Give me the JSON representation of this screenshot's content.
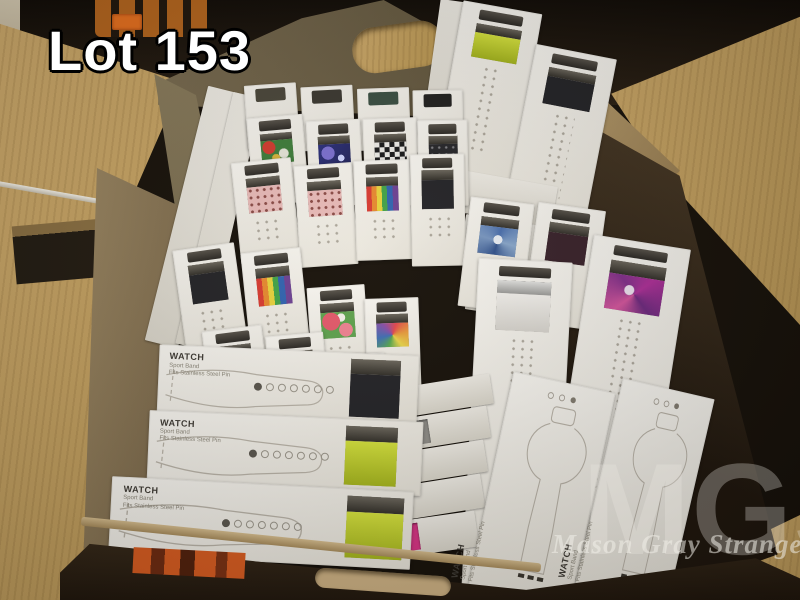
{
  "overlay": {
    "lot_label": "Lot 153"
  },
  "watermark": {
    "initials": "MGS",
    "name": "Mason Gray Strange"
  },
  "package_label": {
    "title": "WATCH",
    "line1": "Sport Band",
    "line2": "Fits Stainless Steel Pin"
  },
  "colors": {
    "cardboard_interior": "#6b5f49",
    "cardboard_exterior": "#b2976b",
    "wood_table": "#c9a869",
    "package_white": "#f4f2ec",
    "lot_sticker_orange": "#d85c20",
    "band_lime": "#c6d92e",
    "band_pink": "#d63384"
  },
  "scene": {
    "packages": [
      {
        "k": "edge",
        "x": 176,
        "y": 86,
        "w": 34,
        "h": 262,
        "r": 14
      },
      {
        "k": "edge",
        "x": 204,
        "y": 92,
        "w": 30,
        "h": 258,
        "r": 13
      },
      {
        "k": "edge",
        "x": 430,
        "y": 0,
        "w": 26,
        "h": 152,
        "r": 8
      },
      {
        "k": "tallwin",
        "x": 448,
        "y": 6,
        "w": 80,
        "h": 172,
        "r": 10,
        "b": "lime",
        "wh": 20
      },
      {
        "k": "tallwin",
        "x": 518,
        "y": 50,
        "w": 82,
        "h": 185,
        "r": 11,
        "b": "black",
        "wh": 20
      },
      {
        "k": "edge",
        "x": 455,
        "y": 178,
        "w": 100,
        "h": 42,
        "r": 10
      },
      {
        "k": "edge",
        "x": 462,
        "y": 222,
        "w": 106,
        "h": 46,
        "r": 9
      },
      {
        "k": "edge",
        "x": 468,
        "y": 268,
        "w": 112,
        "h": 50,
        "r": 9
      },
      {
        "k": "tabonly",
        "x": 246,
        "y": 84,
        "w": 52,
        "h": 64,
        "r": -4,
        "t": "#4a463a"
      },
      {
        "k": "tabonly",
        "x": 302,
        "y": 86,
        "w": 52,
        "h": 64,
        "r": -3,
        "t": "#3b3831"
      },
      {
        "k": "tabonly",
        "x": 358,
        "y": 88,
        "w": 52,
        "h": 62,
        "r": -2,
        "t": "#3a4f43"
      },
      {
        "k": "tabonly",
        "x": 413,
        "y": 90,
        "w": 50,
        "h": 62,
        "r": -1,
        "t": "#20201f"
      },
      {
        "k": "upright",
        "x": 250,
        "y": 116,
        "w": 56,
        "h": 88,
        "r": -5,
        "b": "fruit-camo"
      },
      {
        "k": "upright",
        "x": 308,
        "y": 120,
        "w": 54,
        "h": 86,
        "r": -3,
        "b": "galaxy"
      },
      {
        "k": "upright",
        "x": 364,
        "y": 118,
        "w": 54,
        "h": 88,
        "r": -2,
        "b": "checker"
      },
      {
        "k": "upright",
        "x": 418,
        "y": 120,
        "w": 50,
        "h": 86,
        "r": -1,
        "b": "black-dots"
      },
      {
        "k": "upright",
        "x": 236,
        "y": 160,
        "w": 60,
        "h": 102,
        "r": -6,
        "b": "pink-dots"
      },
      {
        "k": "upright",
        "x": 297,
        "y": 164,
        "w": 58,
        "h": 102,
        "r": -4,
        "b": "pink-dots"
      },
      {
        "k": "upright",
        "x": 355,
        "y": 160,
        "w": 56,
        "h": 100,
        "r": -2,
        "b": "rainbow"
      },
      {
        "k": "upright",
        "x": 411,
        "y": 154,
        "w": 54,
        "h": 112,
        "r": -1,
        "b": "black"
      },
      {
        "k": "upright",
        "x": 180,
        "y": 246,
        "w": 62,
        "h": 114,
        "r": -8,
        "b": "black"
      },
      {
        "k": "upright",
        "x": 246,
        "y": 250,
        "w": 60,
        "h": 112,
        "r": -6,
        "b": "rainbow"
      },
      {
        "k": "upright",
        "x": 310,
        "y": 286,
        "w": 58,
        "h": 102,
        "r": -4,
        "b": "watermelon"
      },
      {
        "k": "upright",
        "x": 366,
        "y": 298,
        "w": 54,
        "h": 96,
        "r": -2,
        "b": "tie-dye-rainbow"
      },
      {
        "k": "upright",
        "x": 206,
        "y": 328,
        "w": 60,
        "h": 74,
        "r": -7,
        "b": "black"
      },
      {
        "k": "upright",
        "x": 268,
        "y": 334,
        "w": 58,
        "h": 68,
        "r": -5,
        "b": "pink-dots"
      },
      {
        "k": "upright",
        "x": 330,
        "y": 354,
        "w": 56,
        "h": 62,
        "r": -3,
        "b": "watermelon"
      },
      {
        "k": "tallwin",
        "x": 464,
        "y": 200,
        "w": 64,
        "h": 110,
        "r": 7,
        "b": "tie-dye-blue",
        "wh": 34
      },
      {
        "k": "tallwin",
        "x": 530,
        "y": 206,
        "w": 68,
        "h": 120,
        "r": 8,
        "b": "maroon",
        "wh": 32
      },
      {
        "k": "tallwin",
        "x": 470,
        "y": 260,
        "w": 94,
        "h": 332,
        "r": 3,
        "b": "white",
        "wh": 15,
        "lug": "silver"
      },
      {
        "k": "tallwin",
        "x": 566,
        "y": 240,
        "w": 98,
        "h": 352,
        "r": 9,
        "b": "tie-dye-pink",
        "wh": 14
      },
      {
        "k": "edge",
        "x": 408,
        "y": 380,
        "w": 84,
        "h": 30,
        "r": -9
      },
      {
        "k": "edgewin",
        "x": 405,
        "y": 412,
        "w": 84,
        "h": 32,
        "r": -9,
        "b": "gray"
      },
      {
        "k": "edge",
        "x": 402,
        "y": 446,
        "w": 84,
        "h": 32,
        "r": -9
      },
      {
        "k": "edge",
        "x": 399,
        "y": 480,
        "w": 84,
        "h": 34,
        "r": -9
      },
      {
        "k": "edgewin",
        "x": 397,
        "y": 516,
        "w": 80,
        "h": 36,
        "r": -8,
        "b": "magenta"
      },
      {
        "k": "longh",
        "x": 158,
        "y": 350,
        "w": 260,
        "h": 72,
        "r": 2.5,
        "b": "black",
        "lx": 74
      },
      {
        "k": "longh",
        "x": 148,
        "y": 416,
        "w": 274,
        "h": 74,
        "r": 2.5,
        "b": "lime",
        "lx": 72
      },
      {
        "k": "longh",
        "x": 110,
        "y": 484,
        "w": 302,
        "h": 78,
        "r": 3,
        "b": "lime",
        "lx": 78
      },
      {
        "k": "lineartv",
        "x": 490,
        "y": 380,
        "w": 104,
        "h": 218,
        "r": 12
      },
      {
        "k": "lineartv",
        "x": 598,
        "y": 386,
        "w": 94,
        "h": 212,
        "r": 13
      }
    ]
  }
}
